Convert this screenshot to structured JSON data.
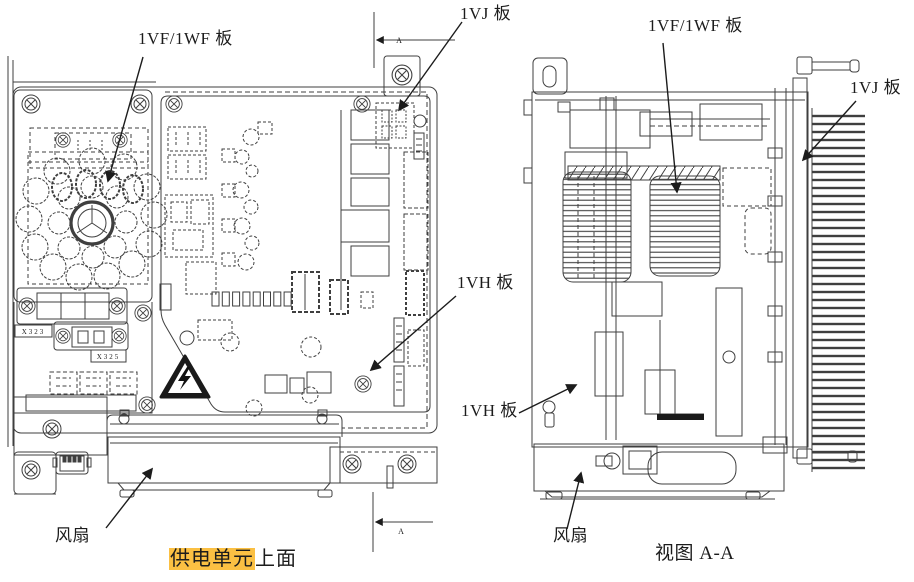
{
  "document": {
    "type": "technical-diagram",
    "subject": "power supply unit drawing, top view and section view"
  },
  "colors": {
    "line": "#3f3f3f",
    "text": "#1c1c1c",
    "highlight": "#fbc043",
    "paper": "#ffffff"
  },
  "left_view": {
    "label_1vf_board": "1VF/1WF 板",
    "label_1vj_board": "1VJ 板",
    "label_1vh_board": "1VH 板",
    "label_fan": "风扇",
    "connector_label_x323": "X323",
    "connector_label_x325": "X325",
    "section_letter_top": "A",
    "section_letter_bottom": "A",
    "caption_highlighted": "供电单元",
    "caption_rest": "上面"
  },
  "right_view": {
    "label_1vf_board": "1VF/1WF 板",
    "label_1vj_board": "1VJ 板",
    "label_1vh_board": "1VH 板",
    "label_fan": "风扇",
    "view_title": "视图 A-A"
  }
}
